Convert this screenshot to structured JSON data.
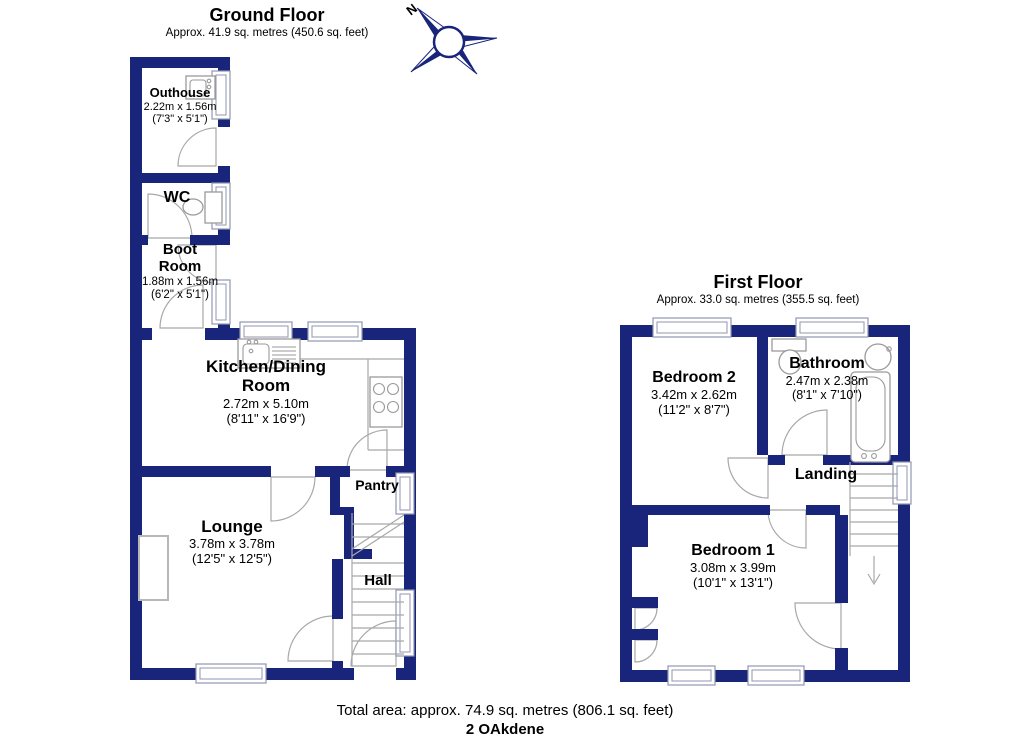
{
  "colors": {
    "wall": "#19247b",
    "window_line": "#9096b0",
    "door_line": "#a8a8a8",
    "text": "#000000"
  },
  "compass": {
    "label": "N"
  },
  "ground_floor": {
    "title": "Ground Floor",
    "subtitle": "Approx. 41.9 sq. metres (450.6 sq. feet)",
    "rooms": [
      {
        "name": "Outhouse",
        "dim_m": "2.22m x 1.56m",
        "dim_ft": "(7'3\" x 5'1\")"
      },
      {
        "name": "WC"
      },
      {
        "name": "Boot Room",
        "dim_m": "1.88m x 1.56m",
        "dim_ft": "(6'2\" x 5'1\")"
      },
      {
        "name": "Kitchen/Dining Room",
        "dim_m": "2.72m x 5.10m",
        "dim_ft": "(8'11\" x 16'9\")"
      },
      {
        "name": "Lounge",
        "dim_m": "3.78m x 3.78m",
        "dim_ft": "(12'5\" x 12'5\")"
      },
      {
        "name": "Pantry"
      },
      {
        "name": "Hall"
      }
    ]
  },
  "first_floor": {
    "title": "First Floor",
    "subtitle": "Approx. 33.0 sq. metres (355.5 sq. feet)",
    "rooms": [
      {
        "name": "Bedroom 2",
        "dim_m": "3.42m x 2.62m",
        "dim_ft": "(11'2\" x 8'7\")"
      },
      {
        "name": "Bathroom",
        "dim_m": "2.47m x 2.38m",
        "dim_ft": "(8'1\" x 7'10\")"
      },
      {
        "name": "Landing"
      },
      {
        "name": "Bedroom 1",
        "dim_m": "3.08m x 3.99m",
        "dim_ft": "(10'1\" x 13'1\")"
      }
    ]
  },
  "footer": {
    "total_area": "Total area: approx. 74.9 sq. metres (806.1 sq. feet)",
    "address": "2 OAkdene"
  }
}
